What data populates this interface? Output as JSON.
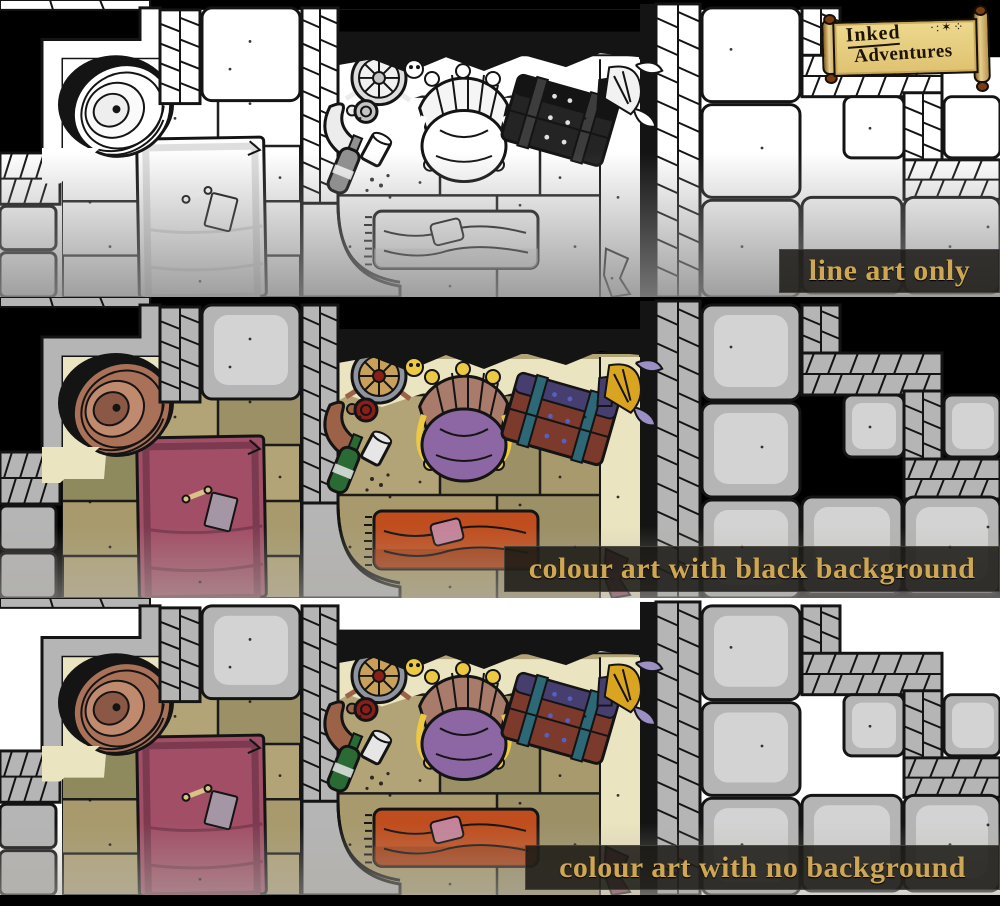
{
  "title": "Inked Adventures dungeon tile art comparison",
  "logo": {
    "line1": "Inked",
    "line2": "Adventures",
    "doodles": "·:✶⁘"
  },
  "panels": [
    {
      "label": "line art only",
      "variant": "line-art",
      "background": "#ffffff"
    },
    {
      "label": "colour art with black background",
      "variant": "colour",
      "background": "#000000"
    },
    {
      "label": "colour art with no background",
      "variant": "colour",
      "background": "#ffffff"
    }
  ],
  "caption_style": {
    "text_color": "#cfa651",
    "band_color": "rgba(26,24,20,0.86)"
  },
  "scene": {
    "objects": [
      "stone-walls",
      "rope-edged-walls",
      "floor-tiles",
      "barrel",
      "pink-rug",
      "bone",
      "paper-scrap",
      "round-shield",
      "crossed-spears",
      "skull",
      "throne-with-skeleton",
      "treasure-chest",
      "golden-crown-with-feathers",
      "waterskin",
      "wine-goblet",
      "cup",
      "wine-bottle",
      "bed-with-orange-blanket",
      "maroon-cloth-scrap",
      "stone-blocks"
    ]
  },
  "map_palette": {
    "stone": "#b5b5b5",
    "floor": "#b3a478",
    "cream_highlight": "#ebe4c0",
    "rug": "#a24e66",
    "barrel": "#a97158",
    "bed": "#c04d1d",
    "throne_wood": "#a87b6b",
    "cushion": "#8d67a4",
    "bone": "#ecc943",
    "chest_body": "#7c3a2c",
    "chest_lid": "#463e6e",
    "gold": "#d9a521",
    "bottle_green": "#2a6b35",
    "ink": "#141414"
  }
}
